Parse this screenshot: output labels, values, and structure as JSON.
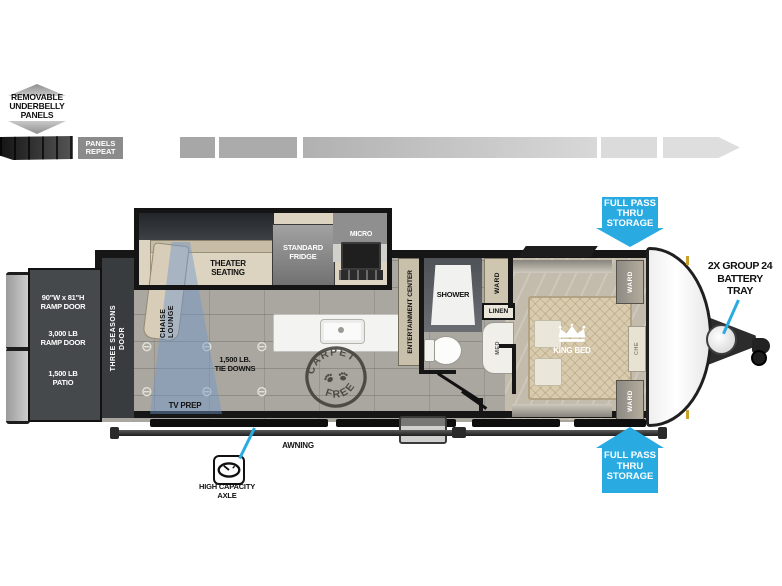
{
  "legend": {
    "underbelly_lines": [
      "REMOVABLE",
      "UNDERBELLY",
      "PANELS"
    ],
    "panels_repeat_lines": [
      "PANELS",
      "REPEAT"
    ]
  },
  "rear": {
    "ramp_size_lines": [
      "90\"W x 81\"H",
      "RAMP DOOR"
    ],
    "ramp_weight_lines": [
      "3,000 LB",
      "RAMP DOOR"
    ],
    "patio_lines": [
      "1,500 LB",
      "PATIO"
    ],
    "three_seasons_col1": "THREE SEASONS",
    "three_seasons_col2": "DOOR"
  },
  "living": {
    "chaise_col1": "CHAISE",
    "chaise_col2": "LOUNGE",
    "theater_lines": [
      "THEATER",
      "SEATING"
    ],
    "fridge_lines": [
      "STANDARD",
      "FRIDGE"
    ],
    "micro": "MICRO",
    "entertainment": "ENTERTAINMENT CENTER",
    "tie_downs_lines": [
      "1,500 LB.",
      "TIE DOWNS"
    ],
    "tv_prep": "TV PREP"
  },
  "bath": {
    "shower": "SHOWER",
    "ward": "WARD",
    "linen": "LINEN",
    "med": "MED"
  },
  "bedroom": {
    "king_bed": "KING BED",
    "ward_top": "WARD",
    "ward_bottom": "WARD",
    "chest": "CHE"
  },
  "stamp": {
    "arc_top": "CARPET",
    "arc_bottom": "FREE"
  },
  "exterior": {
    "awning": "AWNING",
    "axle_lines": [
      "HIGH CAPACITY",
      "AXLE"
    ],
    "battery_lines": [
      "2X GROUP 24",
      "BATTERY",
      "TRAY"
    ],
    "storage_top_lines": [
      "FULL PASS",
      "THRU",
      "STORAGE"
    ],
    "storage_bottom_lines": [
      "FULL PASS",
      "THRU",
      "STORAGE"
    ]
  },
  "colors": {
    "accent_blue": "#29ABE2",
    "wall_black": "#161616",
    "floor_gray": "#A9A7A0"
  }
}
